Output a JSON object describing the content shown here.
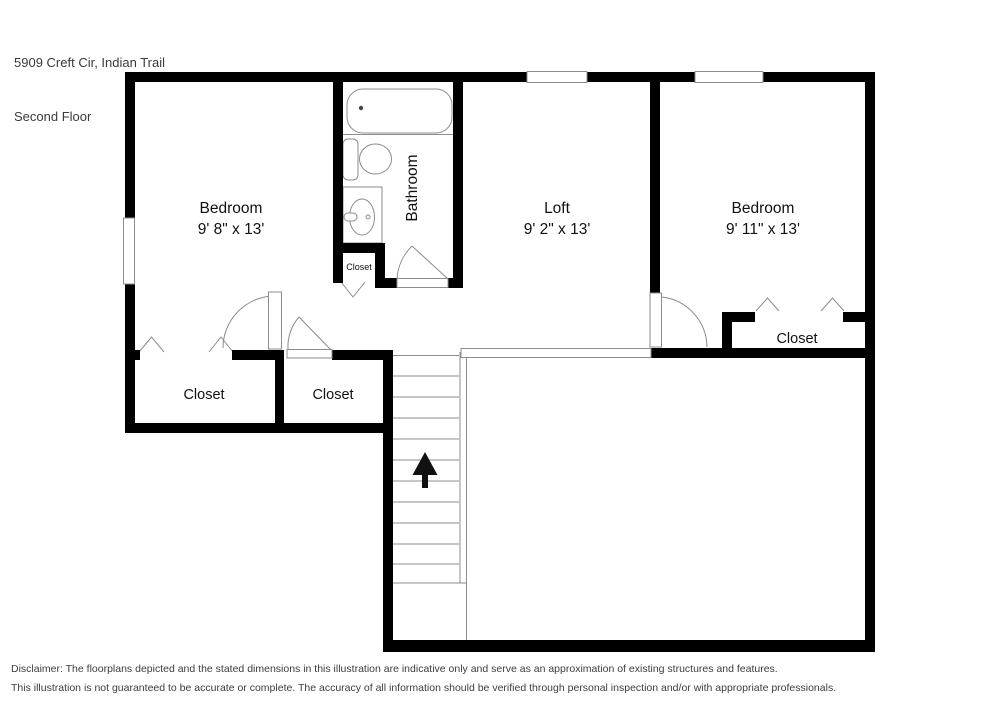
{
  "header": {
    "address": "5909 Creft Cir, Indian Trail",
    "floor_label": "Second Floor"
  },
  "rooms": {
    "bedroom_left": {
      "label": "Bedroom",
      "dimensions": "9' 8\" x 13'"
    },
    "loft": {
      "label": "Loft",
      "dimensions": "9' 2\" x 13'"
    },
    "bedroom_right": {
      "label": "Bedroom",
      "dimensions": "9' 11\" x 13'"
    },
    "bathroom": {
      "label": "Bathroom"
    }
  },
  "closets": {
    "bedroom_left_closet": {
      "label": "Closet"
    },
    "hall_closet": {
      "label": "Closet"
    },
    "bathroom_closet": {
      "label": "Closet"
    },
    "bedroom_right_closet": {
      "label": "Closet"
    }
  },
  "stairs": {
    "direction_icon": "up-arrow"
  },
  "colors": {
    "wall": "#000000",
    "fixture_line": "#8c8c8c",
    "label_text": "#111111",
    "header_text": "#3a3a3a",
    "disclaimer_text": "#3d3d3d",
    "background": "#ffffff"
  },
  "disclaimer": {
    "line1": "Disclaimer: The floorplans depicted and the stated dimensions in this illustration are indicative only and serve as an approximation of existing structures and features.",
    "line2": "This illustration is not guaranteed to be accurate or complete. The accuracy of all information should be verified through personal inspection and/or with appropriate professionals."
  }
}
